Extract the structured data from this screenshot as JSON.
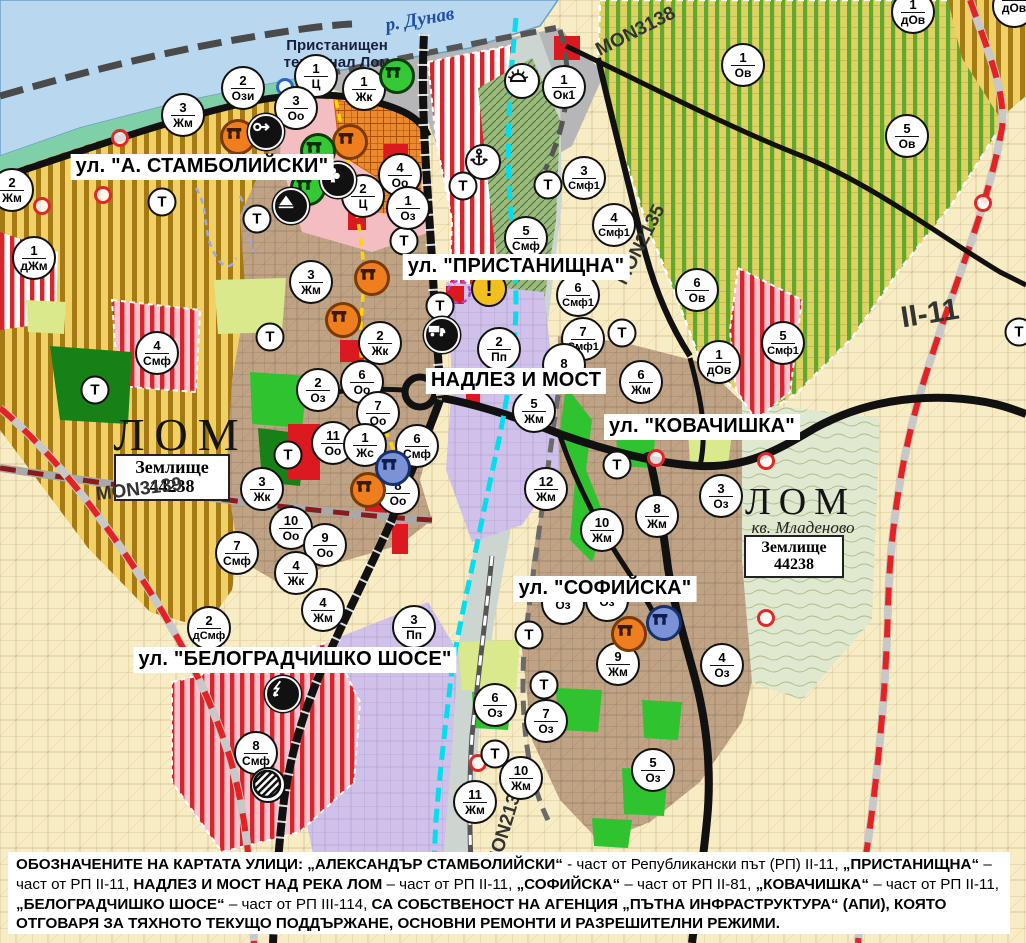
{
  "labels": {
    "river": "р. Дунав",
    "port_terminal_line1": "Пристанищен",
    "port_terminal_line2": "терминал Лом",
    "city_west": "ЛОМ",
    "city_east": "ЛОМ",
    "district_east": "кв. Младеново",
    "landplot_name": "Землище",
    "landplot_code": "44238",
    "transport_symbol": "Т"
  },
  "street_labels": [
    {
      "text": "ул. \"А. СТАМБОЛИЙСКИ\"",
      "x": 202,
      "y": 167
    },
    {
      "text": "ул. \"ПРИСТАНИЩНА\"",
      "x": 516,
      "y": 267
    },
    {
      "text": "НАДЛЕЗ И МОСТ",
      "x": 516,
      "y": 381
    },
    {
      "text": "ул. \"КОВАЧИШКА\"",
      "x": 702,
      "y": 427
    },
    {
      "text": "ул. \"СОФИЙСКА\"",
      "x": 605,
      "y": 589
    },
    {
      "text": "ул. \"БЕЛОГРАДЧИШКО ШОСЕ\"",
      "x": 295,
      "y": 660
    }
  ],
  "road_labels": [
    {
      "text": "MON3138",
      "x": 636,
      "y": 32,
      "rot": -27,
      "size": 19
    },
    {
      "text": "MON2135",
      "x": 641,
      "y": 245,
      "rot": -63,
      "size": 19
    },
    {
      "text": "II-11",
      "x": 930,
      "y": 314,
      "rot": -9,
      "size": 30
    },
    {
      "text": "MON3139",
      "x": 139,
      "y": 490,
      "rot": -7,
      "size": 19
    },
    {
      "text": "MON2136",
      "x": 506,
      "y": 826,
      "rot": -73,
      "size": 19
    }
  ],
  "zone_markers": [
    {
      "n": "2",
      "c": "Ози",
      "x": 243,
      "y": 88
    },
    {
      "n": "1",
      "c": "Ц",
      "x": 316,
      "y": 76
    },
    {
      "n": "3",
      "c": "Оо",
      "x": 296,
      "y": 108
    },
    {
      "n": "1",
      "c": "Жк",
      "x": 364,
      "y": 89
    },
    {
      "n": "1",
      "c": "Ок1",
      "x": 564,
      "y": 87
    },
    {
      "n": "3",
      "c": "Жм",
      "x": 183,
      "y": 115
    },
    {
      "n": "2",
      "c": "Жм",
      "x": 12,
      "y": 190
    },
    {
      "n": "1",
      "c": "дЖм",
      "x": 34,
      "y": 258
    },
    {
      "n": "4",
      "c": "Оо",
      "x": 400,
      "y": 175
    },
    {
      "n": "2",
      "c": "Ц",
      "x": 363,
      "y": 196
    },
    {
      "n": "1",
      "c": "Оз",
      "x": 408,
      "y": 208
    },
    {
      "n": "3",
      "c": "Жм",
      "x": 311,
      "y": 282
    },
    {
      "n": "3",
      "c": "Смф1",
      "x": 584,
      "y": 178
    },
    {
      "n": "4",
      "c": "Смф1",
      "x": 614,
      "y": 225
    },
    {
      "n": "5",
      "c": "Смф",
      "x": 526,
      "y": 238
    },
    {
      "n": "6",
      "c": "Смф1",
      "x": 578,
      "y": 295
    },
    {
      "n": "7",
      "c": "Смф1",
      "x": 583,
      "y": 339
    },
    {
      "n": "2",
      "c": "Пп",
      "x": 499,
      "y": 349
    },
    {
      "n": "2",
      "c": "Жк",
      "x": 380,
      "y": 343
    },
    {
      "n": "6",
      "c": "Оо",
      "x": 362,
      "y": 382
    },
    {
      "n": "2",
      "c": "Оз",
      "x": 318,
      "y": 390
    },
    {
      "n": "7",
      "c": "Оо",
      "x": 378,
      "y": 413
    },
    {
      "n": "11",
      "c": "Оо",
      "x": 333,
      "y": 443
    },
    {
      "n": "1",
      "c": "Жс",
      "x": 365,
      "y": 445
    },
    {
      "n": "6",
      "c": "Смф",
      "x": 417,
      "y": 446
    },
    {
      "n": "8",
      "c": "Оо",
      "x": 398,
      "y": 493
    },
    {
      "n": "3",
      "c": "Жк",
      "x": 262,
      "y": 489
    },
    {
      "n": "10",
      "c": "Оо",
      "x": 291,
      "y": 528
    },
    {
      "n": "9",
      "c": "Оо",
      "x": 325,
      "y": 545
    },
    {
      "n": "4",
      "c": "Жк",
      "x": 296,
      "y": 573
    },
    {
      "n": "7",
      "c": "Смф",
      "x": 237,
      "y": 553
    },
    {
      "n": "4",
      "c": "Смф",
      "x": 157,
      "y": 353
    },
    {
      "n": "8",
      "c": "",
      "x": 564,
      "y": 365
    },
    {
      "n": "5",
      "c": "Жм",
      "x": 534,
      "y": 411
    },
    {
      "n": "6",
      "c": "Жм",
      "x": 641,
      "y": 382
    },
    {
      "n": "12",
      "c": "Жм",
      "x": 546,
      "y": 489
    },
    {
      "n": "8",
      "c": "Жм",
      "x": 657,
      "y": 516
    },
    {
      "n": "10",
      "c": "Жм",
      "x": 602,
      "y": 530
    },
    {
      "n": "3",
      "c": "Оз",
      "x": 721,
      "y": 496
    },
    {
      "n": "1",
      "c": "Ов",
      "x": 743,
      "y": 65
    },
    {
      "n": "5",
      "c": "Ов",
      "x": 907,
      "y": 136
    },
    {
      "n": "1",
      "c": "дОв",
      "x": 913,
      "y": 12
    },
    {
      "n": "6",
      "c": "Ов",
      "x": 697,
      "y": 290
    },
    {
      "n": "1",
      "c": "дОв",
      "x": 719,
      "y": 362
    },
    {
      "n": "5",
      "c": "Смф1",
      "x": 783,
      "y": 343
    },
    {
      "n": "2",
      "c": "дСмф",
      "x": 209,
      "y": 628
    },
    {
      "n": "4",
      "c": "Жм",
      "x": 323,
      "y": 610
    },
    {
      "n": "3",
      "c": "Пп",
      "x": 414,
      "y": 627
    },
    {
      "n": "8",
      "c": "Смф",
      "x": 256,
      "y": 753
    },
    {
      "n": "9",
      "c": "Жм",
      "x": 618,
      "y": 664
    },
    {
      "n": "4",
      "c": "Оз",
      "x": 722,
      "y": 665
    },
    {
      "n": "6",
      "c": "Оз",
      "x": 495,
      "y": 705
    },
    {
      "n": "7",
      "c": "Оз",
      "x": 546,
      "y": 721
    },
    {
      "n": "10",
      "c": "Жм",
      "x": 521,
      "y": 778
    },
    {
      "n": "11",
      "c": "Жм",
      "x": 475,
      "y": 802
    },
    {
      "n": "5",
      "c": "Оз",
      "x": 653,
      "y": 770
    },
    {
      "n": "",
      "c": "Оз",
      "x": 563,
      "y": 603
    },
    {
      "n": "",
      "c": "Оз",
      "x": 607,
      "y": 600
    },
    {
      "n": "",
      "c": "дОв",
      "x": 1014,
      "y": 6
    }
  ],
  "t_markers": [
    {
      "x": 162,
      "y": 202
    },
    {
      "x": 257,
      "y": 219
    },
    {
      "x": 270,
      "y": 337
    },
    {
      "x": 95,
      "y": 390
    },
    {
      "x": 288,
      "y": 455
    },
    {
      "x": 404,
      "y": 241
    },
    {
      "x": 463,
      "y": 186
    },
    {
      "x": 548,
      "y": 185
    },
    {
      "x": 440,
      "y": 306
    },
    {
      "x": 617,
      "y": 465
    },
    {
      "x": 529,
      "y": 635
    },
    {
      "x": 544,
      "y": 685
    },
    {
      "x": 495,
      "y": 754
    },
    {
      "x": 622,
      "y": 333
    },
    {
      "x": 1019,
      "y": 332
    }
  ],
  "poi_icons": [
    {
      "type": "monument-orange",
      "x": 238,
      "y": 137
    },
    {
      "type": "monument-orange",
      "x": 350,
      "y": 142
    },
    {
      "type": "monument-orange",
      "x": 372,
      "y": 278
    },
    {
      "type": "monument-orange",
      "x": 343,
      "y": 320
    },
    {
      "type": "monument-orange",
      "x": 368,
      "y": 490
    },
    {
      "type": "monument-orange",
      "x": 629,
      "y": 634
    },
    {
      "type": "monument-green",
      "x": 397,
      "y": 76
    },
    {
      "type": "monument-green",
      "x": 318,
      "y": 151
    },
    {
      "type": "monument-green",
      "x": 308,
      "y": 188
    },
    {
      "type": "monument-blue",
      "x": 393,
      "y": 468
    },
    {
      "type": "monument-blue",
      "x": 664,
      "y": 623
    },
    {
      "type": "arrow-black",
      "x": 266,
      "y": 132
    },
    {
      "type": "club-black",
      "x": 338,
      "y": 180
    },
    {
      "type": "tunnel-black",
      "x": 291,
      "y": 206
    },
    {
      "type": "anchor-white",
      "x": 483,
      "y": 162
    },
    {
      "type": "sun-white",
      "x": 522,
      "y": 81
    },
    {
      "type": "warning-yellow",
      "x": 489,
      "y": 289
    },
    {
      "type": "truck-black",
      "x": 442,
      "y": 335
    },
    {
      "type": "lightning-black",
      "x": 283,
      "y": 694
    },
    {
      "type": "hazard-striped",
      "x": 268,
      "y": 785
    }
  ],
  "ring_markers": [
    {
      "hex": "#e02828",
      "x": 120,
      "y": 138
    },
    {
      "hex": "#e02828",
      "x": 103,
      "y": 195
    },
    {
      "hex": "#e02828",
      "x": 42,
      "y": 206
    },
    {
      "hex": "#e02828",
      "x": 656,
      "y": 458
    },
    {
      "hex": "#e02828",
      "x": 766,
      "y": 461
    },
    {
      "hex": "#e02828",
      "x": 766,
      "y": 618
    },
    {
      "hex": "#e02828",
      "x": 478,
      "y": 763
    },
    {
      "hex": "#e02828",
      "x": 983,
      "y": 203
    },
    {
      "hex": "#2f62c8",
      "x": 285,
      "y": 87
    }
  ],
  "footer": {
    "segments": [
      {
        "t": "ОБОЗНАЧЕНИТЕ НА КАРТАТА УЛИЦИ: „АЛЕКСАНДЪР СТАМБОЛИЙСКИ“",
        "b": true
      },
      {
        "t": " - част от Републикански път (РП) II-11, ",
        "b": false
      },
      {
        "t": "„ПРИСТАНИЩНА“",
        "b": true
      },
      {
        "t": " – част от РП II-11, ",
        "b": false
      },
      {
        "t": "НАДЛЕЗ И МОСТ НАД РЕКА ЛОМ",
        "b": true
      },
      {
        "t": " – част от РП II-11, ",
        "b": false
      },
      {
        "t": "„СОФИЙСКА“",
        "b": true
      },
      {
        "t": " – част от РП II-81, ",
        "b": false
      },
      {
        "t": "„КОВАЧИШКА“",
        "b": true
      },
      {
        "t": " – част от РП II-11, ",
        "b": false
      },
      {
        "t": "„БЕЛОГРАДЧИШКО ШОСЕ“",
        "b": true
      },
      {
        "t": " – част от РП III-114, ",
        "b": false
      },
      {
        "t": "СА СОБСТВЕНОСТ НА АГЕНЦИЯ „ПЪТНА ИНФРАСТРУКТУРА“ (АПИ), КОЯТО ОТГОВАРЯ ЗА ТЯХНОТО ТЕКУЩО ПОДДЪРЖАНЕ, ОСНОВНИ РЕМОНТИ И РАЗРЕШИТЕЛНИ РЕЖИМИ.",
        "b": true
      }
    ]
  },
  "colors": {
    "water": "#b9d7ee",
    "accent_red": "#d7252d",
    "vineyard_green": "#61a92e",
    "park_green": "#178017",
    "bright_green": "#2fc32f",
    "purple": "#cfc1e9",
    "town_brown": "#c0a385",
    "beige": "#f8ecc4",
    "cyan": "#00dff0",
    "zone_yellow": "#f1d166"
  }
}
